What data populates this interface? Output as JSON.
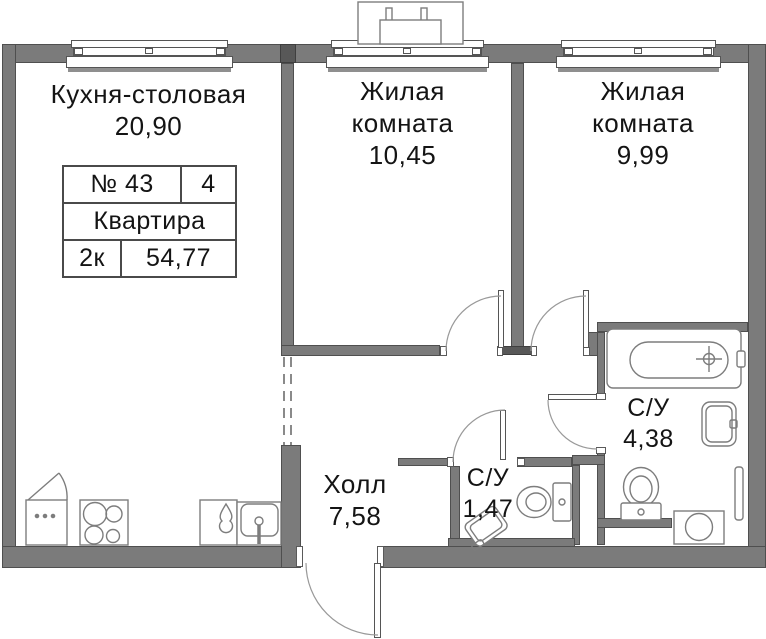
{
  "info_table": {
    "number": "№ 43",
    "unit_count": "4",
    "type": "Квартира",
    "rooms_code": "2к",
    "area_total": "54,77"
  },
  "rooms": {
    "kitchen": {
      "name": "Кухня-столовая",
      "area": "20,90"
    },
    "living1": {
      "line1": "Жилая",
      "line2": "комната",
      "area": "10,45"
    },
    "living2": {
      "line1": "Жилая",
      "line2": "комната",
      "area": "9,99"
    },
    "hall": {
      "name": "Холл",
      "area": "7,58"
    },
    "wc_small": {
      "name": "С/У",
      "area": "1,47"
    },
    "wc_big": {
      "name": "С/У",
      "area": "4,38"
    }
  },
  "icons": [
    "window",
    "door-swing",
    "bathtub",
    "washbasin",
    "toilet",
    "washing-machine",
    "towel-rail",
    "kitchen-sink",
    "stove-hob",
    "fridge",
    "teardrop-cabinet",
    "corner-washbasin",
    "ac-basket",
    "vent-shaft"
  ],
  "colors": {
    "wall": "#7b7b7b",
    "wall_dark": "#585858",
    "outline": "#555555",
    "fixture_stroke": "#7d7d7d",
    "arc": "#999999",
    "text": "#141414",
    "background": "#ffffff"
  }
}
